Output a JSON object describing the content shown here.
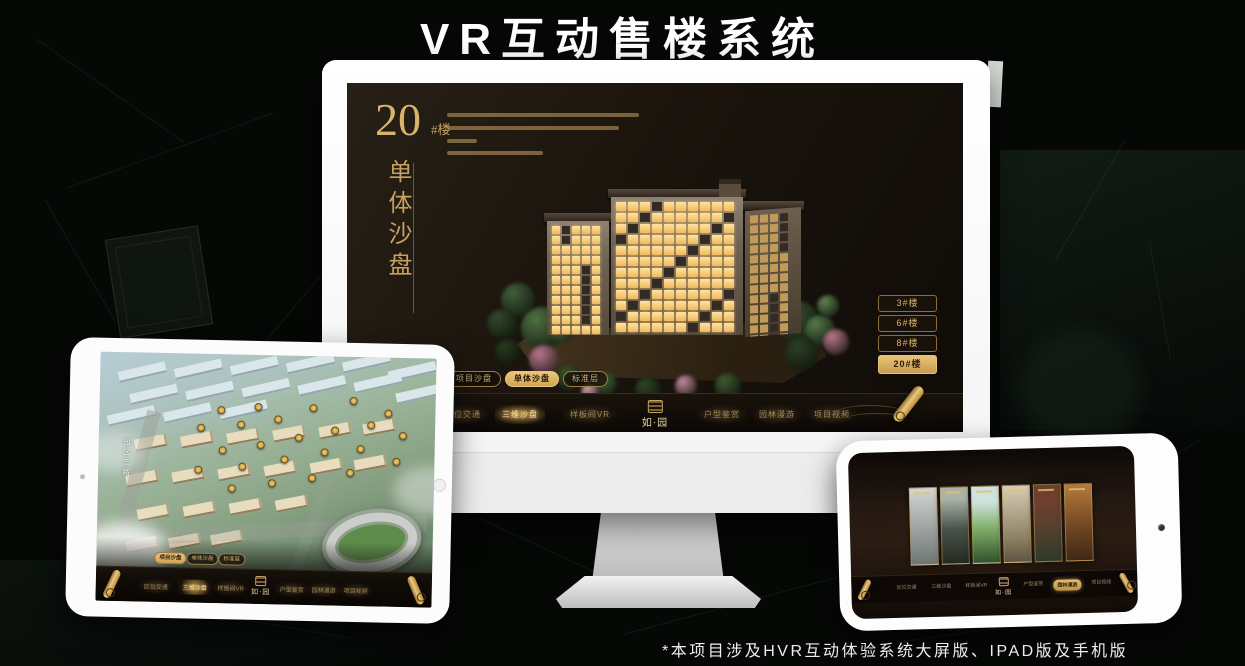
{
  "page": {
    "title": "VR互动售楼系统",
    "footnote": "*本项目涉及HVR互动体验系统大屏版、IPAD版及手机版"
  },
  "colors": {
    "gold": "#c9a05f",
    "gold_active": "#e9c377",
    "screen_bg": "#1a130d",
    "bezel_white": "#fcfcfc"
  },
  "nav": {
    "logo": "如·园",
    "items": [
      "区位交通",
      "三维沙盘",
      "样板间VR",
      "户型鉴赏",
      "园林漫游",
      "项目视频"
    ]
  },
  "view_tabs": [
    "项目沙盘",
    "单体沙盘",
    "标准层"
  ],
  "desktop": {
    "heading": {
      "number": "20",
      "suffix": "#楼",
      "vertical": "单体沙盘"
    },
    "building_buttons": [
      "3#楼",
      "6#楼",
      "8#楼",
      "20#楼"
    ],
    "active_button": "20#楼",
    "active_tab": "单体沙盘",
    "active_nav": "三维沙盘"
  },
  "tablet": {
    "road_label": "园区三路",
    "active_tab": "项目沙盘",
    "active_nav": "三维沙盘"
  },
  "phone": {
    "active_nav": "园林漫游"
  }
}
